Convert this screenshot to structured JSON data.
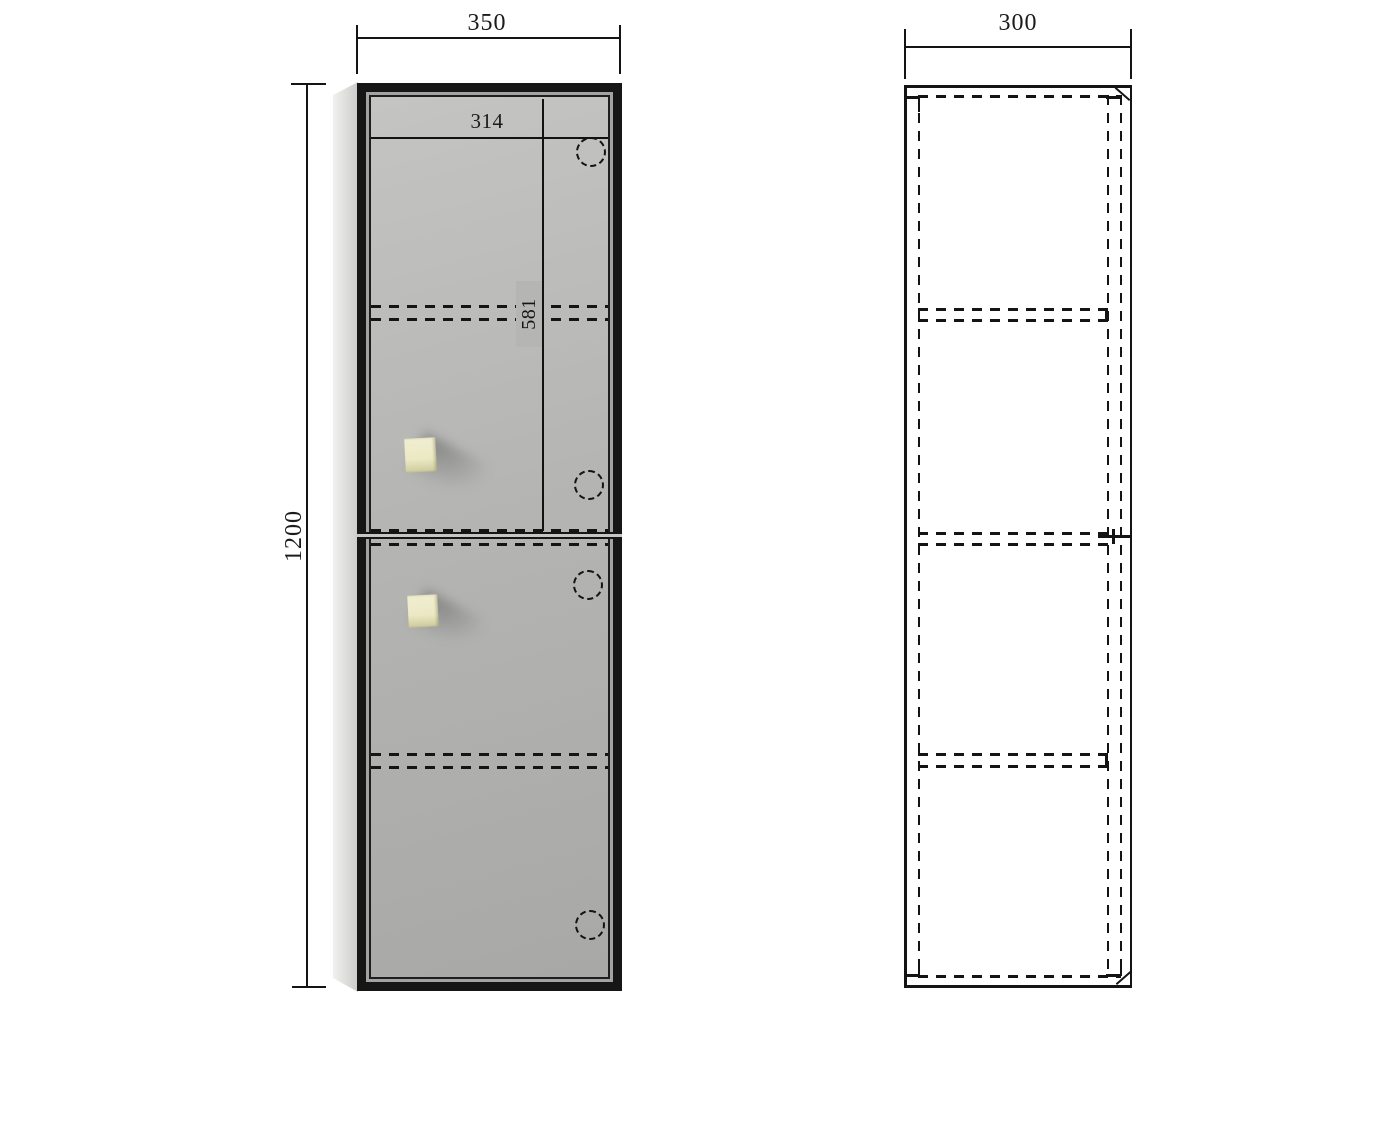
{
  "drawing": {
    "dimensions": {
      "front_width": "350",
      "front_height": "1200",
      "inner_width": "314",
      "upper_door_height": "581",
      "side_depth": "300"
    },
    "colors": {
      "line": "#141414",
      "frame": "#161616",
      "face": "#b5b5b3",
      "face_light": "#c4c4c2",
      "face_dark": "#a8a8a6",
      "side_panel_light": "#f1f1ef",
      "side_panel_dark": "#cccccb",
      "handle": "#ebe9c4",
      "handle_edge": "#cdca9c",
      "background": "#ffffff"
    }
  }
}
